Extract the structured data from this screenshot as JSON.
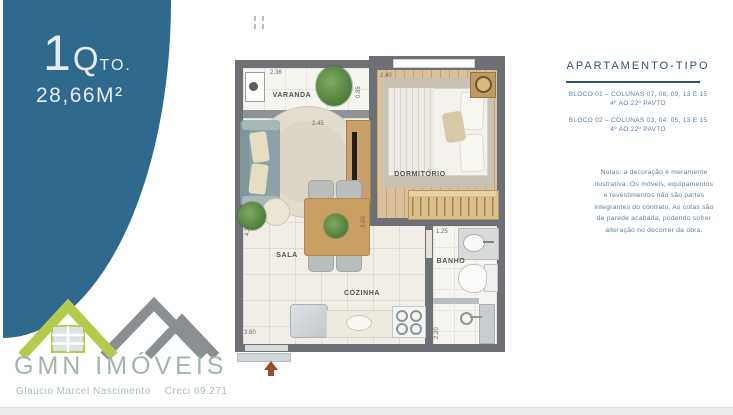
{
  "badge": {
    "quantity": "1",
    "quantity_q": "Q",
    "quantity_suffix": "TO.",
    "area": "28,66M²"
  },
  "plan": {
    "rooms": {
      "varanda": "VARANDA",
      "dormitorio": "DORMITÓRIO",
      "sala": "SALA",
      "cozinha": "COZINHA",
      "banho": "BANHO"
    },
    "dims": {
      "varanda_width": "2.36",
      "varanda_depth": "0.85",
      "dorm_width": "2.40",
      "sala_opening": "2.45",
      "sala_depth": "4.30",
      "kitchen_depth": "3.00",
      "banho_width": "1.25",
      "shower_depth": "2.20",
      "entry_width": "3.60"
    }
  },
  "info": {
    "title": "APARTAMENTO-TIPO",
    "blocks": [
      {
        "line1": "BLOCO 01 – COLUNAS 07, 08, 09, 13 E 15",
        "line2": "4º AO 22º PAVTO"
      },
      {
        "line1": "BLOCO 02 – COLUNAS 03, 04, 05, 13 E 15",
        "line2": "4º AO 22º PAVTO"
      }
    ],
    "note_lines": [
      "Notas: a decoração é meramente",
      "ilustrativa. Os móveis, equipamentos",
      "e revestimentos não são partes",
      "integrantes do contrato. As cotas são",
      "de parede acabada, podendo sofrer",
      "alteração no decorrer da obra."
    ]
  },
  "brand": {
    "name": "GMN IMÓVEIS",
    "agent_name": "Glaucio Marcel Nascimento",
    "license": "Creci 69.271",
    "colors": {
      "accent_blue": "#2f6a8e",
      "logo_green": "#b4cb4e",
      "logo_gray": "#8a8f93",
      "entry_arrow": "#9c4a2c"
    }
  }
}
